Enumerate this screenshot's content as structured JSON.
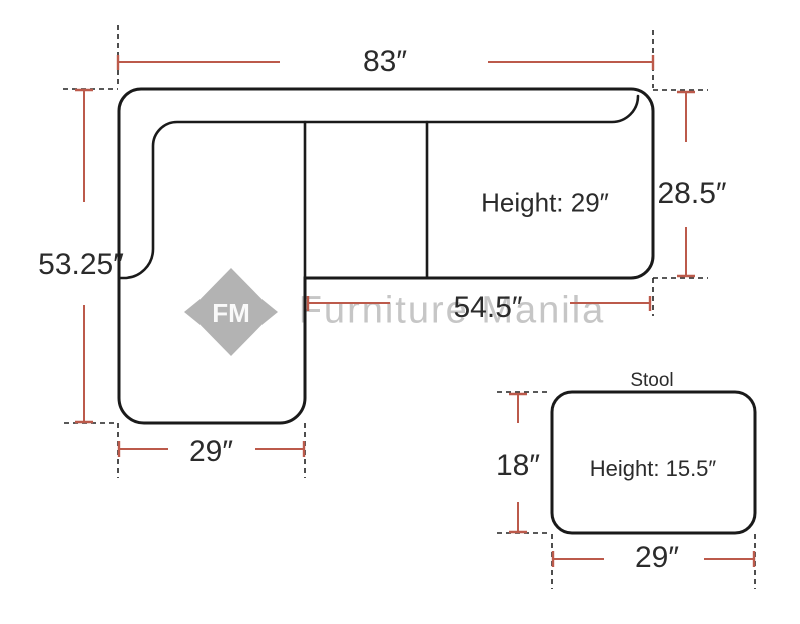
{
  "title": "Sectional sofa with stool dimension diagram",
  "watermark": {
    "brand": "Furniture Manila",
    "monogram": "FM"
  },
  "dimensions": {
    "sofa": {
      "overall_width": "83″",
      "chaise_depth": "53.25″",
      "body_depth": "28.5″",
      "height": "Height: 29″",
      "seat_width": "54.5″",
      "chaise_width": "29″"
    },
    "stool": {
      "title": "Stool",
      "height": "Height: 15.5″",
      "depth": "18″",
      "width": "29″"
    }
  },
  "colors": {
    "outline": "#1a1a1a",
    "dimension_red": "#bc5a4b",
    "watermark_text_gray": "#c6c6c6",
    "logo_gray": "#b3b3b3"
  }
}
